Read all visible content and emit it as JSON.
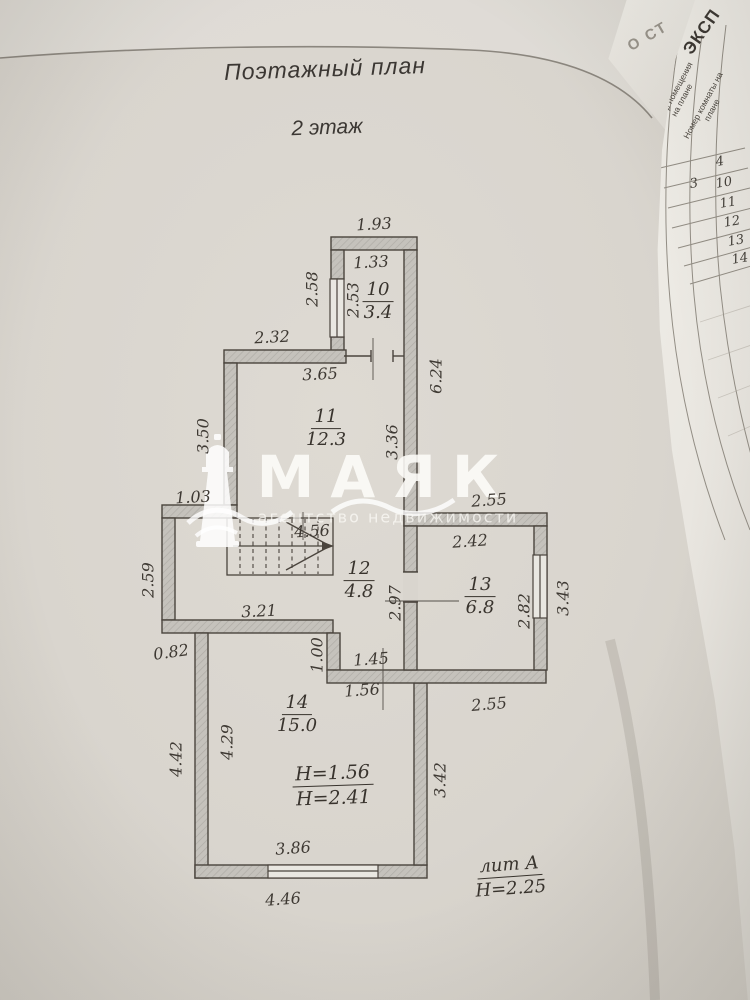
{
  "plan": {
    "title": "Поэтажный план",
    "floor": "2 этаж",
    "rooms": [
      {
        "number": "10",
        "area": "3.4"
      },
      {
        "number": "11",
        "area": "12.3"
      },
      {
        "number": "12",
        "area": "4.8"
      },
      {
        "number": "13",
        "area": "6.8"
      },
      {
        "number": "14",
        "area": "15.0"
      }
    ],
    "dims": {
      "d193": "1.93",
      "d133": "1.33",
      "d258": "2.58",
      "d253": "2.53",
      "d232": "2.32",
      "d365": "3.65",
      "d624": "6.24",
      "d350": "3.50",
      "d336": "3.36",
      "d103": "1.03",
      "d456": "4.56",
      "d255top": "2.55",
      "d242": "2.42",
      "d259": "2.59",
      "d321": "3.21",
      "d297": "2.97",
      "d282": "2.82",
      "d343": "3.43",
      "d082": "0.82",
      "d100": "1.00",
      "d145": "1.45",
      "d156": "1.56",
      "d255bot": "2.55",
      "d429": "4.29",
      "d442": "4.42",
      "d342": "3.42",
      "d386": "3.86",
      "d446": "4.46"
    },
    "heights": {
      "line1": "Н=1.56",
      "line2": "Н=2.41"
    },
    "liter": {
      "line1": "лит А",
      "line2": "Н=2.25"
    }
  },
  "watermark": {
    "brand": "МАЯК",
    "tagline": "агентство недвижимости"
  },
  "side_table": {
    "title_fragment": "ЭКСП",
    "corner_fragment": "О СТ",
    "col1_header": "Номер помещения на плане",
    "col2_header": "Номер комнаты на плане",
    "col1_values": [
      "3"
    ],
    "col2_values": [
      "4",
      "10",
      "11",
      "12",
      "13",
      "14"
    ]
  }
}
